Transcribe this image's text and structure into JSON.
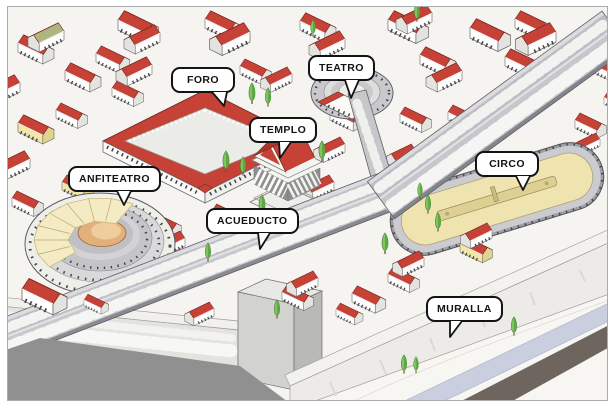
{
  "diagram": {
    "labels": [
      {
        "id": "foro",
        "text": "FORO"
      },
      {
        "id": "teatro",
        "text": "TEATRO"
      },
      {
        "id": "templo",
        "text": "TEMPLO"
      },
      {
        "id": "anfiteatro",
        "text": "ANFITEATRO"
      },
      {
        "id": "acueducto",
        "text": "ACUEDUCTO"
      },
      {
        "id": "circo",
        "text": "CIRCO"
      },
      {
        "id": "muralla",
        "text": "MURALLA"
      }
    ]
  },
  "colors": {
    "roof_red": "#C64237",
    "roof_red_dark": "#AD3429",
    "stone_gray": "#C6C6CB",
    "wall_light": "#ECEBE7",
    "plaza": "#EBEBE8",
    "track_tan": "#EFE4B0",
    "arena_tan": "#E3AF7B",
    "velarium_cream": "#F4EBC4",
    "tree_green": "#7FC45F",
    "river_blue": "#C9CFDF",
    "road_dark": "#6E665E",
    "label_border": "#131313",
    "background": "#F5F4F1"
  }
}
